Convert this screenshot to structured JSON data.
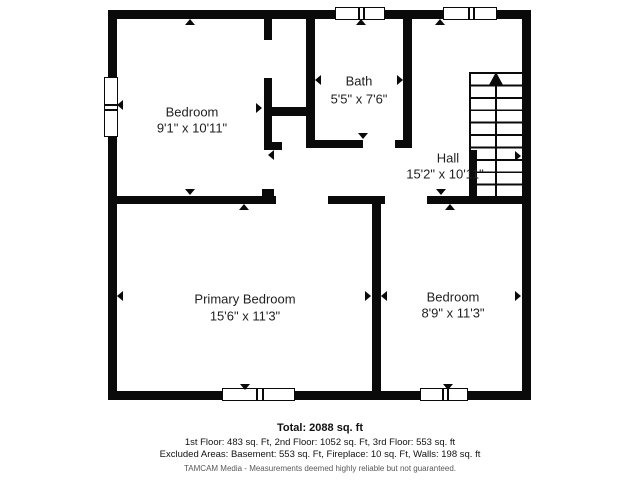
{
  "colors": {
    "wall": "#0a0a0a",
    "background": "#ffffff",
    "text": "#1f1f1f",
    "disclaimer": "#585858"
  },
  "rooms": [
    {
      "name": "Bedroom",
      "dims": "9'1\" x 10'11\""
    },
    {
      "name": "Bath",
      "dims": "5'5\" x 7'6\""
    },
    {
      "name": "Hall",
      "dims": "15'2\" x 10'11\""
    },
    {
      "name": "Primary Bedroom",
      "dims": "15'6\" x 11'3\""
    },
    {
      "name": "Bedroom",
      "dims": "8'9\" x 11'3\""
    }
  ],
  "stairs": {
    "direction": "up"
  },
  "footer": {
    "total": "Total: 2088 sq. ft",
    "floors": "1st Floor: 483 sq. Ft, 2nd Floor: 1052 sq. Ft, 3rd Floor: 553 sq. ft",
    "excluded": "Excluded Areas: Basement: 553 sq. Ft, Fireplace: 10 sq. Ft, Walls: 198 sq. ft",
    "disclaimer": "TAMCAM Media - Measurements deemed highly reliable but not guaranteed."
  }
}
